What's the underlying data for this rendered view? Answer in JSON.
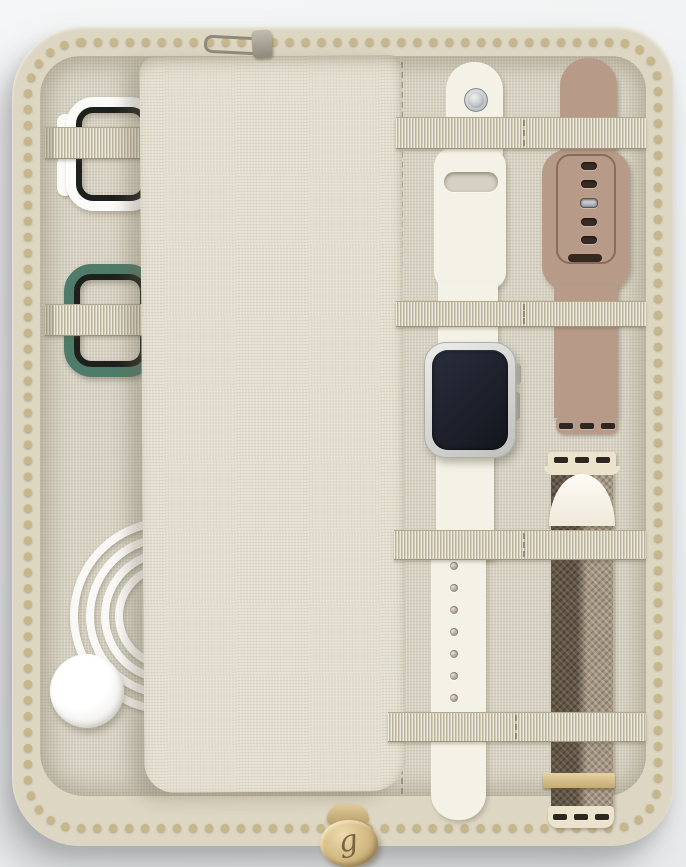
{
  "scene": {
    "type": "product-photo",
    "subject": "Open beige linen zip-around watch band organizer case with Apple Watch bands, watch face and charging cable",
    "monogram_letter": "g"
  },
  "colors": {
    "case-rim": "#ddd6c3",
    "zipper-gold": "#c6b68a",
    "interior": "#d6d1c2",
    "pouch": "#e3decf",
    "strap": "#d4cdb8",
    "band-white": "#f4f1e6",
    "band-taupe": "#b79b88",
    "band-green": "#4e7b6a",
    "loop-white": "#fbfbf9",
    "rim-black": "#1e201d",
    "lug-cream": "#ece3cd",
    "cable-white": "#f9f8f4",
    "gold-pull": "#d2b881",
    "hole-dark": "#382c23",
    "watch-screen": "#232633"
  },
  "details": {
    "taupe_hole_count": 5,
    "tail_hole_count": 7,
    "lug_slot_count": 3
  }
}
